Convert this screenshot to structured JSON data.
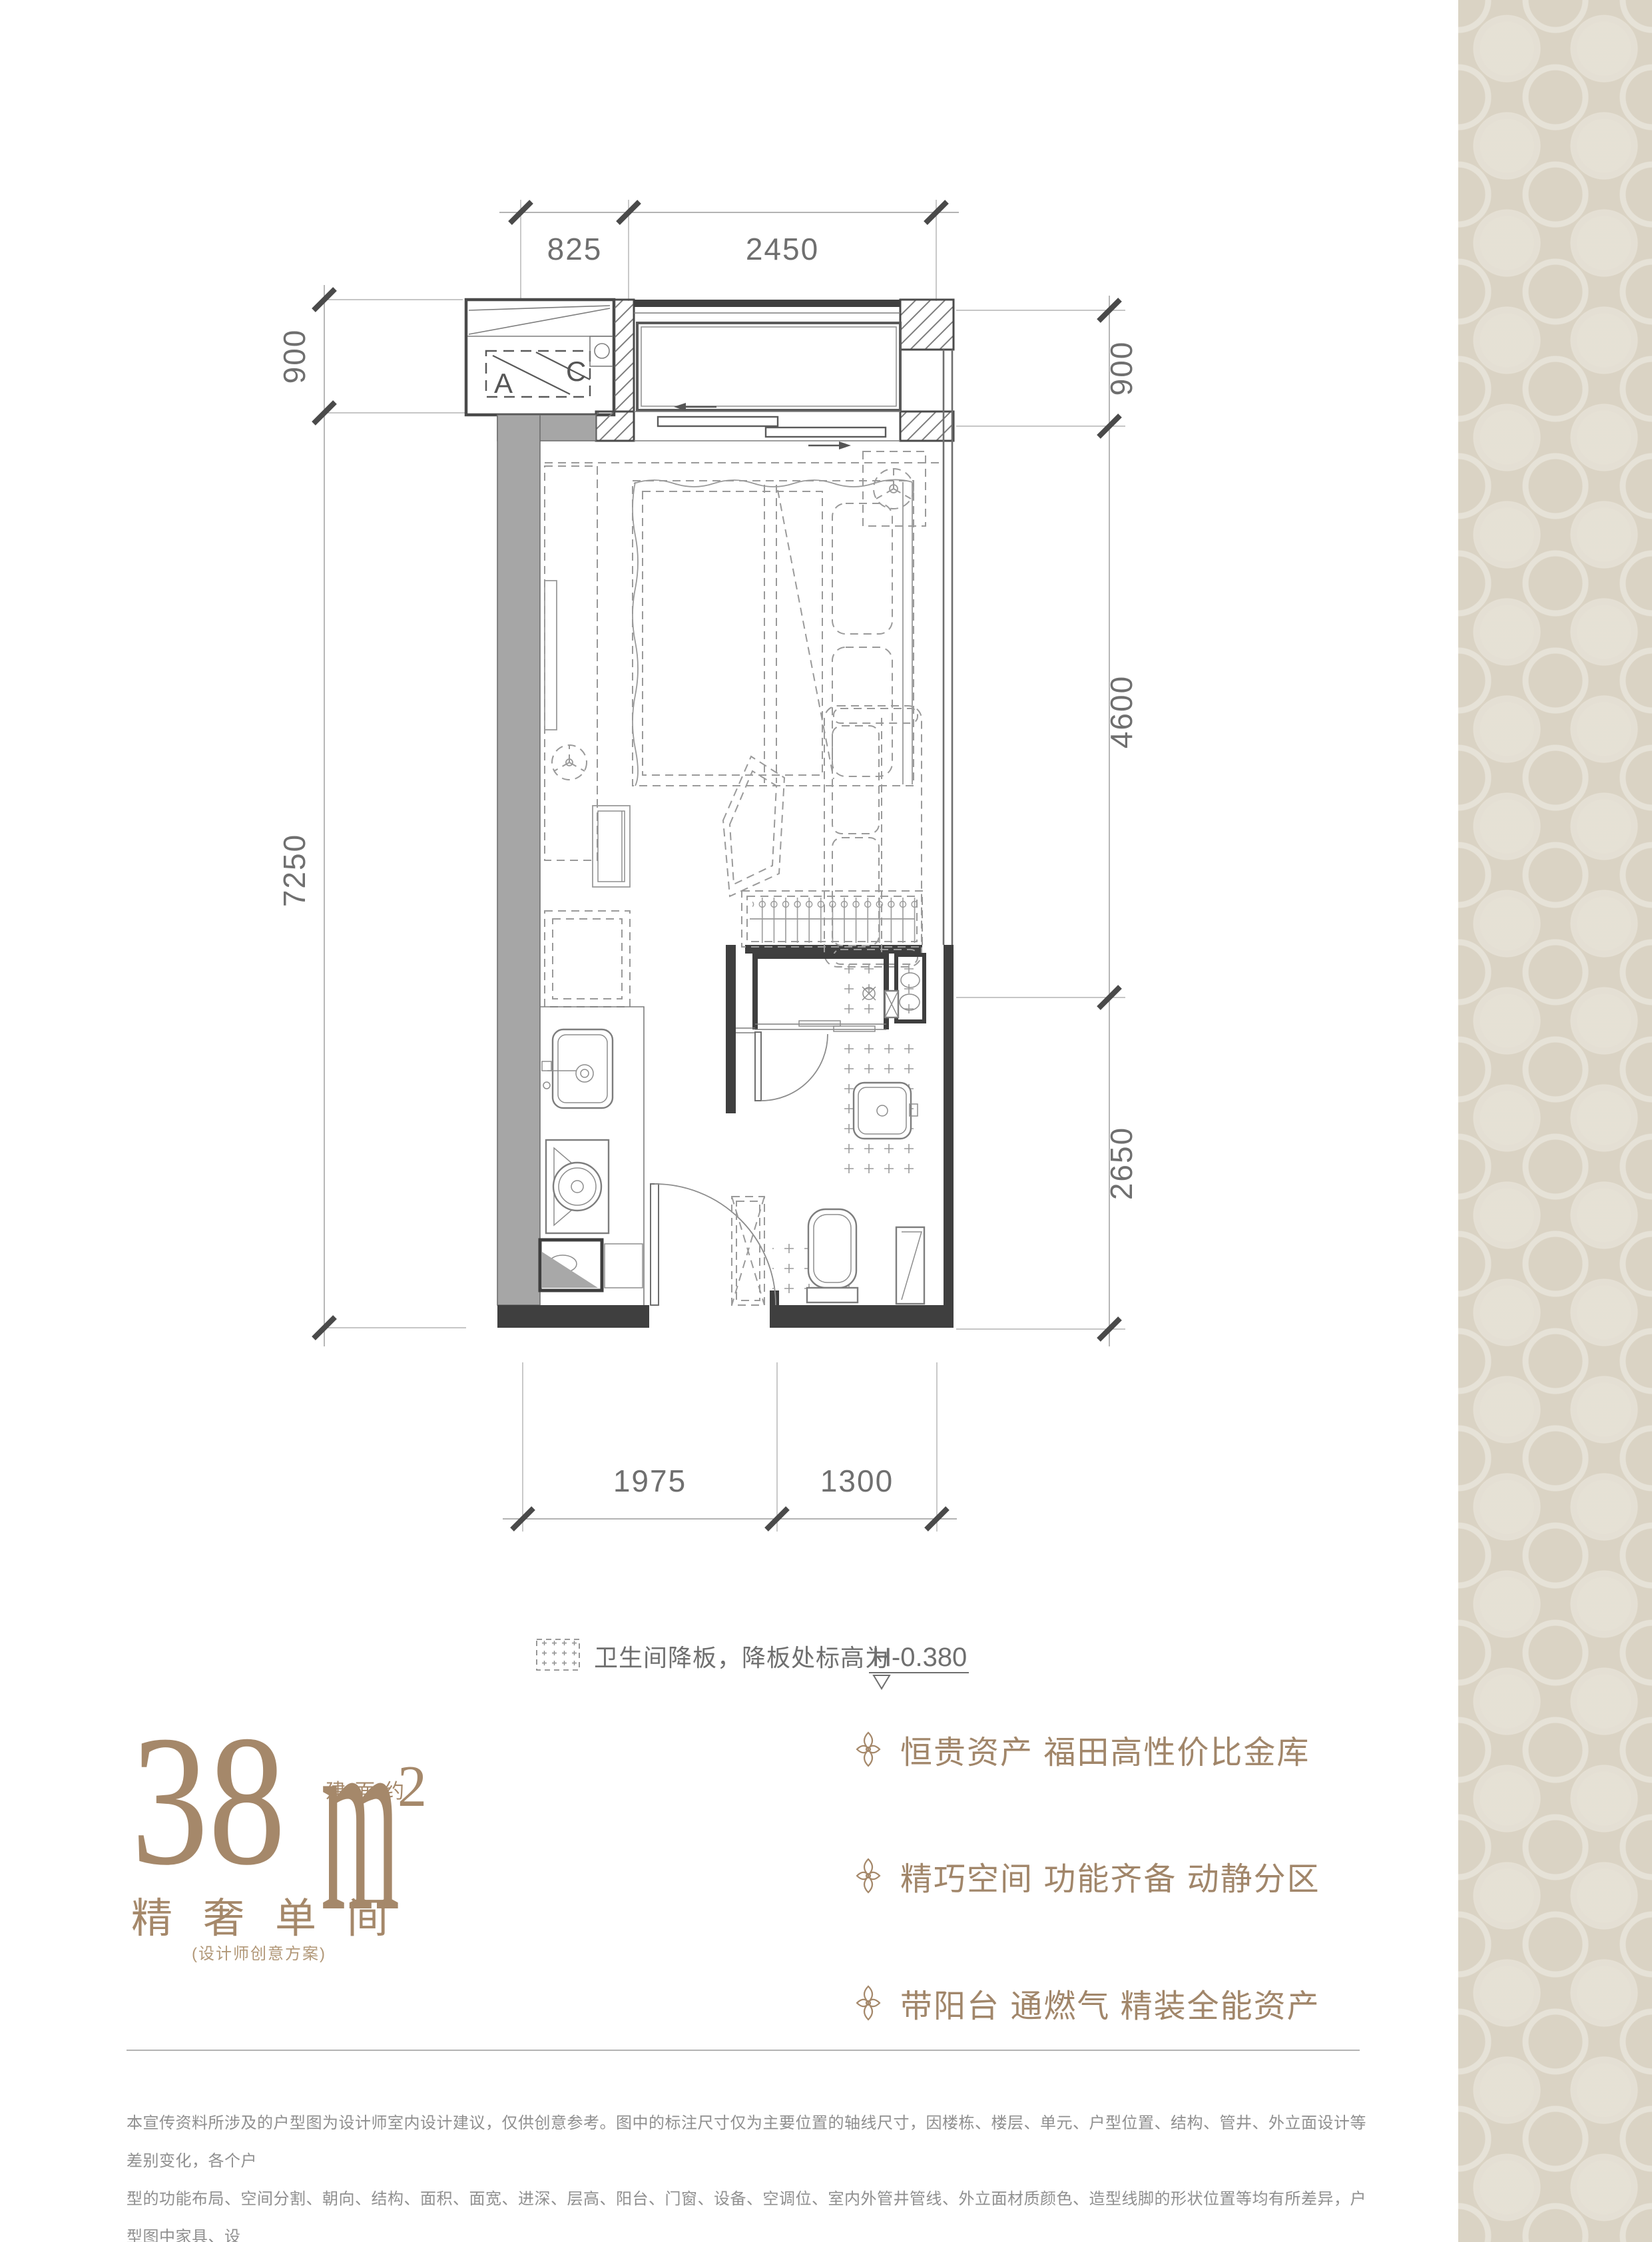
{
  "page": {
    "background": "#ffffff",
    "accent": "#a5886a"
  },
  "plan": {
    "dims": {
      "top": [
        "825",
        "2450"
      ],
      "left": [
        "900",
        "7250"
      ],
      "right": [
        "900",
        "4600",
        "2650"
      ],
      "bottom": [
        "1975",
        "1300"
      ]
    },
    "ac_labels": [
      "A",
      "C"
    ],
    "legend_text": "卫生间降板，降板处标高为",
    "legend_value": "H-0.380"
  },
  "headline": {
    "area": "38",
    "approx": "建面约",
    "unit": "m",
    "sup": "2",
    "title": "精奢单间",
    "subtitle": "(设计师创意方案)"
  },
  "features": [
    {
      "text": "恒贵资产 福田高性价比金库"
    },
    {
      "text": "精巧空间 功能齐备 动静分区"
    },
    {
      "text": "带阳台 通燃气 精装全能资产"
    }
  ],
  "disclaimer": {
    "lines": [
      "本宣传资料所涉及的户型图为设计师室内设计建议，仅供创意参考。图中的标注尺寸仅为主要位置的轴线尺寸，因楼栋、楼层、单元、户型位置、结构、管井、外立面设计等差别变化，各个户",
      "型的功能布局、空间分割、朝向、结构、面积、面宽、进深、层高、阳台、门窗、设备、空调位、室内外管井管线、外立面材质颜色、造型线脚的形状位置等均有所差异，户型图中家具、设",
      "备、户内门等均不属于交付范围，实际交付以政府部门最终批复的方案和销售合同为准。"
    ]
  }
}
